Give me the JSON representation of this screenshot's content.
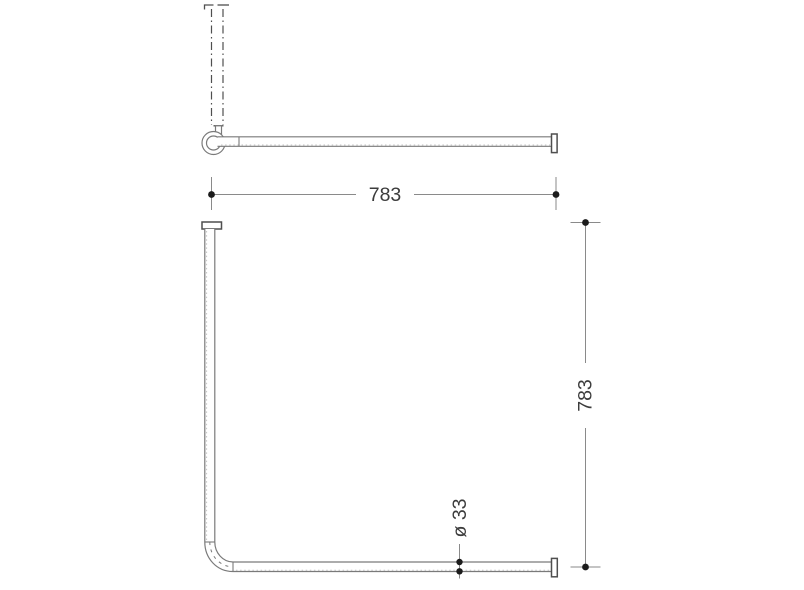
{
  "drawing": {
    "type": "technical-line-drawing",
    "subject": "corner shower curtain rail with ceiling support, front view and plan view",
    "labels": {
      "width": "783",
      "depth": "783",
      "diameter": "ø 33"
    },
    "colors": {
      "background": "#ffffff",
      "line": "#7a7a7a",
      "line_dark": "#4f4f4f",
      "dim": "#8a8a8a",
      "dot": "#1c1c1c",
      "text": "#3c3c3c",
      "highlight": "#c3c3c3"
    }
  }
}
